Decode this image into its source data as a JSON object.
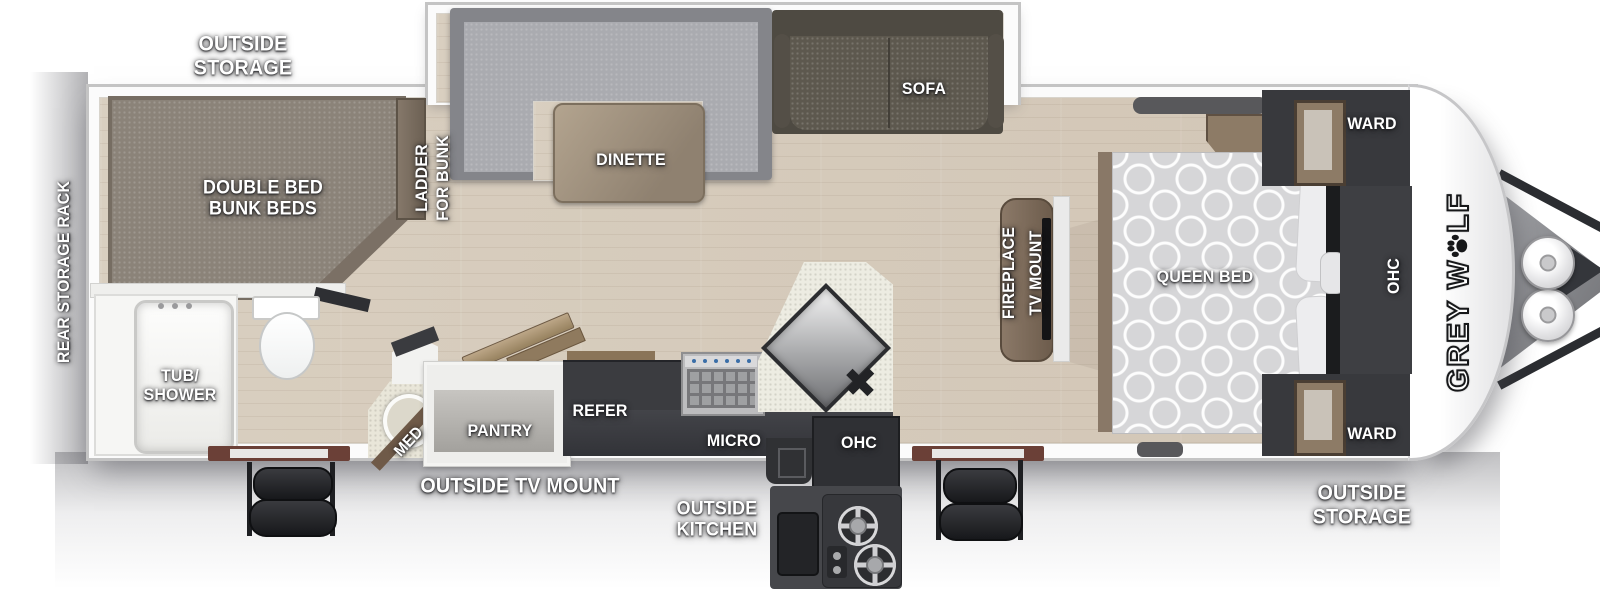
{
  "brand": {
    "pre": "GREY W",
    "post": "LF",
    "full_name": "GREY WOLF"
  },
  "exterior": {
    "outside_storage_rear": {
      "l1": "OUTSIDE",
      "l2": "STORAGE"
    },
    "rear_storage_rack": "REAR STORAGE RACK",
    "outside_tv_mount": "OUTSIDE TV MOUNT",
    "outside_kitchen": {
      "l1": "OUTSIDE",
      "l2": "KITCHEN"
    },
    "outside_storage_front": {
      "l1": "OUTSIDE",
      "l2": "STORAGE"
    }
  },
  "bunk_room": {
    "bunk_bed": {
      "l1": "DOUBLE BED",
      "l2": "BUNK BEDS"
    },
    "ladder": {
      "l1": "LADDER",
      "l2": "FOR BUNK"
    }
  },
  "bathroom": {
    "tub_shower": {
      "l1": "TUB/",
      "l2": "SHOWER"
    },
    "med_cabinet": "MED"
  },
  "kitchen": {
    "pantry": "PANTRY",
    "refrigerator": "REFER",
    "microwave": "MICRO",
    "overhead_cabinet": "OHC"
  },
  "living_area": {
    "dinette": "DINETTE",
    "sofa": "SOFA",
    "entertainment": {
      "l1": "FIREPLACE",
      "l2": "TV MOUNT"
    }
  },
  "bedroom": {
    "bed": "QUEEN BED",
    "wardrobe_rear": "WARD",
    "overhead_cabinet": "OHC",
    "wardrobe_front": "WARD"
  },
  "colors": {
    "floor_wood": "#d7ccbd",
    "cabinet_dark": "#3a3b3f",
    "wood_trim": "#8d7b66",
    "bunk_fabric": "#8b8379",
    "sofa_fabric": "#5d584e",
    "dinette_fabric": "#aaabb0",
    "queen_bed": "#d6d6d8",
    "wall": "#c4c4c4",
    "label_text": "#ffffff"
  }
}
